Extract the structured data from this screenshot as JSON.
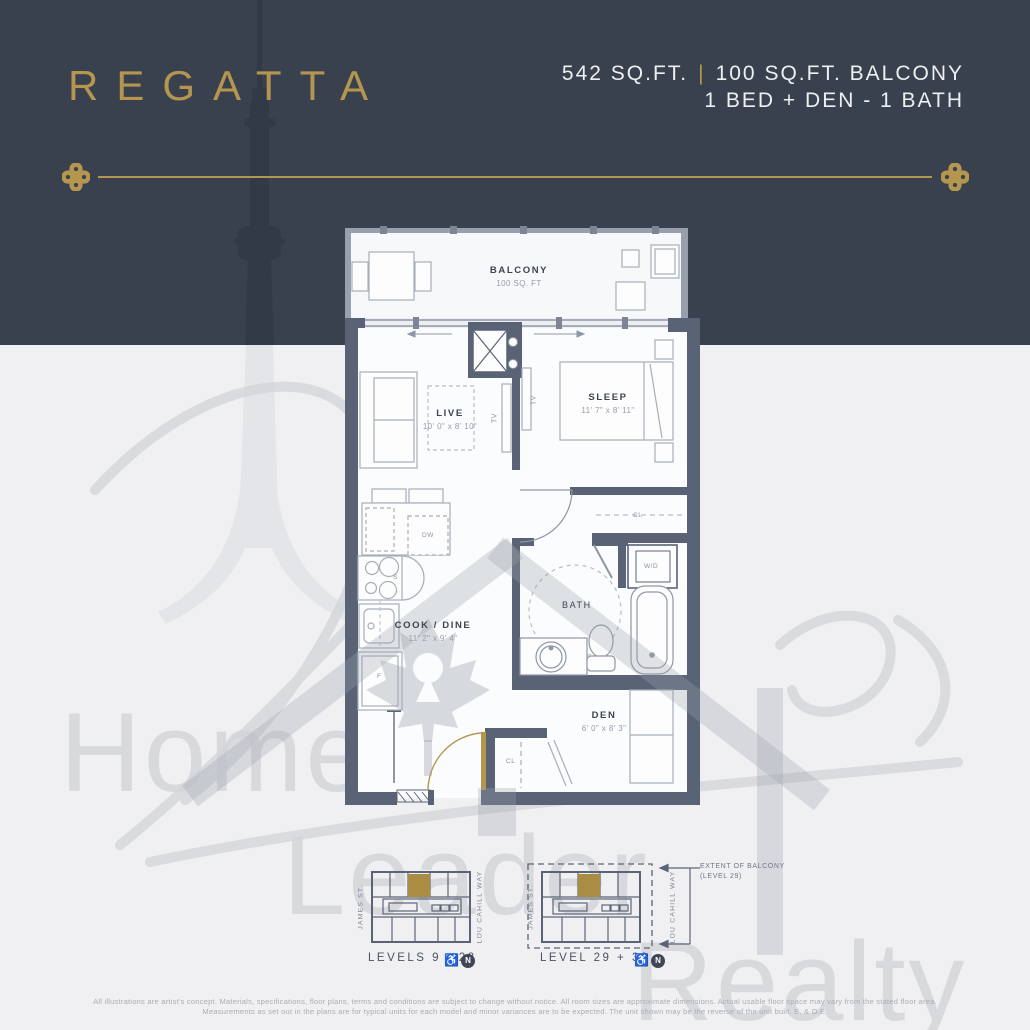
{
  "header": {
    "title": "REGATTA",
    "area": "542 SQ.FT.",
    "divider": "|",
    "balcony_area": "100 SQ.FT. BALCONY",
    "layout": "1 BED + DEN - 1 BATH"
  },
  "plan": {
    "balcony_label": "BALCONY",
    "balcony_dims": "100 SQ. FT",
    "live_label": "LIVE",
    "live_dims": "10' 0\" x 8' 10\"",
    "sleep_label": "SLEEP",
    "sleep_dims": "11' 7\" x 8' 11\"",
    "cook_label": "COOK / DINE",
    "cook_dims": "11' 2\" x 9' 4\"",
    "den_label": "DEN",
    "den_dims": "6' 0\" x 8' 3\"",
    "bath_label": "BATH",
    "wd_label": "W/D",
    "tv_label_live": "TV",
    "tv_label_sleep": "TV",
    "cl_label_sleep": "CL",
    "cl_label_den": "CL",
    "dw_label": "DW",
    "stove_label": "S",
    "fridge_label": "F"
  },
  "keyplans": {
    "plan1_caption": "LEVELS 9 - 28",
    "plan2_caption": "LEVEL 29 + 30",
    "street_left_1": "JAMES ST.",
    "street_right_1": "LOU CAHILL WAY",
    "street_left_2": "JAMES ST.",
    "street_right_2": "LOU CAHILL WAY",
    "north_1": "N",
    "north_2": "N",
    "wheelchair_1": "♿",
    "wheelchair_2": "♿",
    "extent_line1": "EXTENT OF BALCONY",
    "extent_line2": "(LEVEL 29)"
  },
  "watermark": {
    "word1": "Home",
    "word2": "Leader",
    "word3": "Realty"
  },
  "footer": {
    "line1": "All illustrations are artist's concept. Materials, specifications, floor plans, terms and conditions are subject to change without notice. All room sizes are approximate dimensions. Actual usable floor space may vary from the stated floor area.",
    "line2": "Measurements as set out in the plans are for typical units for each model and minor variances are to be expected. The unit shown may be the reverse of the unit built. E. & O.E."
  },
  "colors": {
    "header_bg": "#3A414E",
    "gold": "#B5964F",
    "wall": "#5A6376",
    "page_bg": "#F0F0F2",
    "watermark": "#D8D9DC"
  }
}
